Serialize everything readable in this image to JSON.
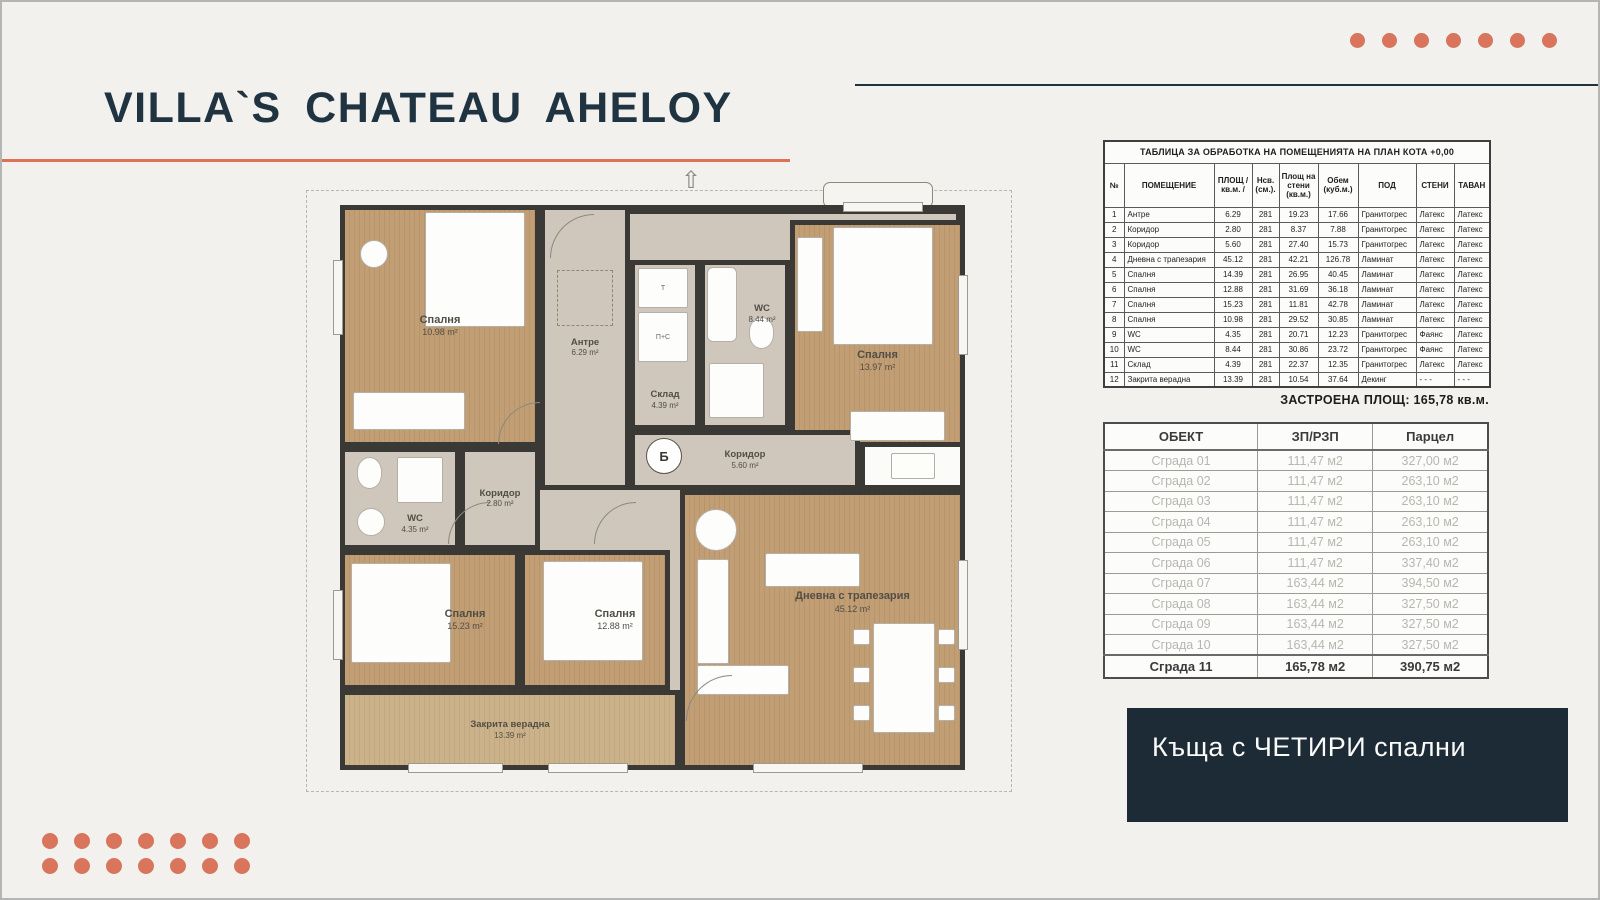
{
  "page": {
    "title": "VILLA`S  CHATEAU AHELOY",
    "tagline": "Къща с ЧЕТИРИ спални"
  },
  "colors": {
    "accent_orange": "#d8755c",
    "navy": "#203341",
    "tagline_bg": "#1d2b36",
    "wood_floor": "#c29e74",
    "hall_floor": "#cfc7bb",
    "wall": "#3a3936"
  },
  "rooms_table": {
    "title": "ТАБЛИЦА ЗА ОБРАБОТКА НА ПОМЕЩЕНИЯТА НА ПЛАН КОТА +0,00",
    "columns": [
      "№",
      "ПОМЕЩЕНИЕ",
      "ПЛОЩ / кв.м. /",
      "Нсв. (см.).",
      "Площ на стени (кв.м.)",
      "Обем (куб.м.)",
      "ПОД",
      "СТЕНИ",
      "ТАВАН"
    ],
    "rows": [
      [
        "1",
        "Антре",
        "6.29",
        "281",
        "19.23",
        "17.66",
        "Гранитогрес",
        "Латекс",
        "Латекс"
      ],
      [
        "2",
        "Коридор",
        "2.80",
        "281",
        "8.37",
        "7.88",
        "Гранитогрес",
        "Латекс",
        "Латекс"
      ],
      [
        "3",
        "Коридор",
        "5.60",
        "281",
        "27.40",
        "15.73",
        "Гранитогрес",
        "Латекс",
        "Латекс"
      ],
      [
        "4",
        "Дневна с трапезария",
        "45.12",
        "281",
        "42.21",
        "126.78",
        "Ламинат",
        "Латекс",
        "Латекс"
      ],
      [
        "5",
        "Спалня",
        "14.39",
        "281",
        "26.95",
        "40.45",
        "Ламинат",
        "Латекс",
        "Латекс"
      ],
      [
        "6",
        "Спалня",
        "12.88",
        "281",
        "31.69",
        "36.18",
        "Ламинат",
        "Латекс",
        "Латекс"
      ],
      [
        "7",
        "Спалня",
        "15.23",
        "281",
        "11.81",
        "42.78",
        "Ламинат",
        "Латекс",
        "Латекс"
      ],
      [
        "8",
        "Спалня",
        "10.98",
        "281",
        "29.52",
        "30.85",
        "Ламинат",
        "Латекс",
        "Латекс"
      ],
      [
        "9",
        "WC",
        "4.35",
        "281",
        "20.71",
        "12.23",
        "Гранитогрес",
        "Фаянс",
        "Латекс"
      ],
      [
        "10",
        "WC",
        "8.44",
        "281",
        "30.86",
        "23.72",
        "Гранитогрес",
        "Фаянс",
        "Латекс"
      ],
      [
        "11",
        "Склад",
        "4.39",
        "281",
        "22.37",
        "12.35",
        "Гранитогрес",
        "Латекс",
        "Латекс"
      ],
      [
        "12",
        "Закрита верадна",
        "13.39",
        "281",
        "10.54",
        "37.64",
        "Декинг",
        "- - -",
        "- - -"
      ]
    ],
    "footer": "ЗАСТРОЕНА ПЛОЩ: 165,78 кв.м."
  },
  "buildings_table": {
    "columns": [
      "ОБЕКТ",
      "ЗП/РЗП",
      "Парцел"
    ],
    "rows": [
      [
        "Сграда 01",
        "111,47 м2",
        "327,00 м2"
      ],
      [
        "Сграда 02",
        "111,47 м2",
        "263,10 м2"
      ],
      [
        "Сграда 03",
        "111,47 м2",
        "263,10 м2"
      ],
      [
        "Сграда 04",
        "111,47 м2",
        "263,10 м2"
      ],
      [
        "Сграда 05",
        "111,47 м2",
        "263,10 м2"
      ],
      [
        "Сграда 06",
        "111,47 м2",
        "337,40 м2"
      ],
      [
        "Сграда 07",
        "163,44 м2",
        "394,50 м2"
      ],
      [
        "Сграда 08",
        "163,44 м2",
        "327,50 м2"
      ],
      [
        "Сграда 09",
        "163,44 м2",
        "327,50 м2"
      ],
      [
        "Сграда 10",
        "163,44 м2",
        "327,50 м2"
      ]
    ],
    "total_row": [
      "Сграда 11",
      "165,78 м2",
      "390,75 м2"
    ]
  },
  "plan": {
    "rooms": [
      {
        "name": "Спалня",
        "area": "10.98 m²"
      },
      {
        "name": "Антре",
        "area": "6.29 m²"
      },
      {
        "name": "Склад",
        "area": "4.39 m²"
      },
      {
        "name": "WC",
        "area": "8.44 m²"
      },
      {
        "name": "Спалня",
        "area": "13.97 m²"
      },
      {
        "name": "WC",
        "area": "4.35 m²"
      },
      {
        "name": "Коридор",
        "area": "2.80 m²"
      },
      {
        "name": "Коридор",
        "area": "5.60 m²"
      },
      {
        "name": "Спалня",
        "area": "15.23 m²"
      },
      {
        "name": "Спалня",
        "area": "12.88 m²"
      },
      {
        "name": "Дневна с трапезария",
        "area": "45.12 m²"
      },
      {
        "name": "Закрита верадна",
        "area": "13.39 m²"
      }
    ],
    "boiler_label": "Б",
    "closet_labels": [
      "Т",
      "П+С"
    ],
    "north_arrow": "⇧"
  }
}
